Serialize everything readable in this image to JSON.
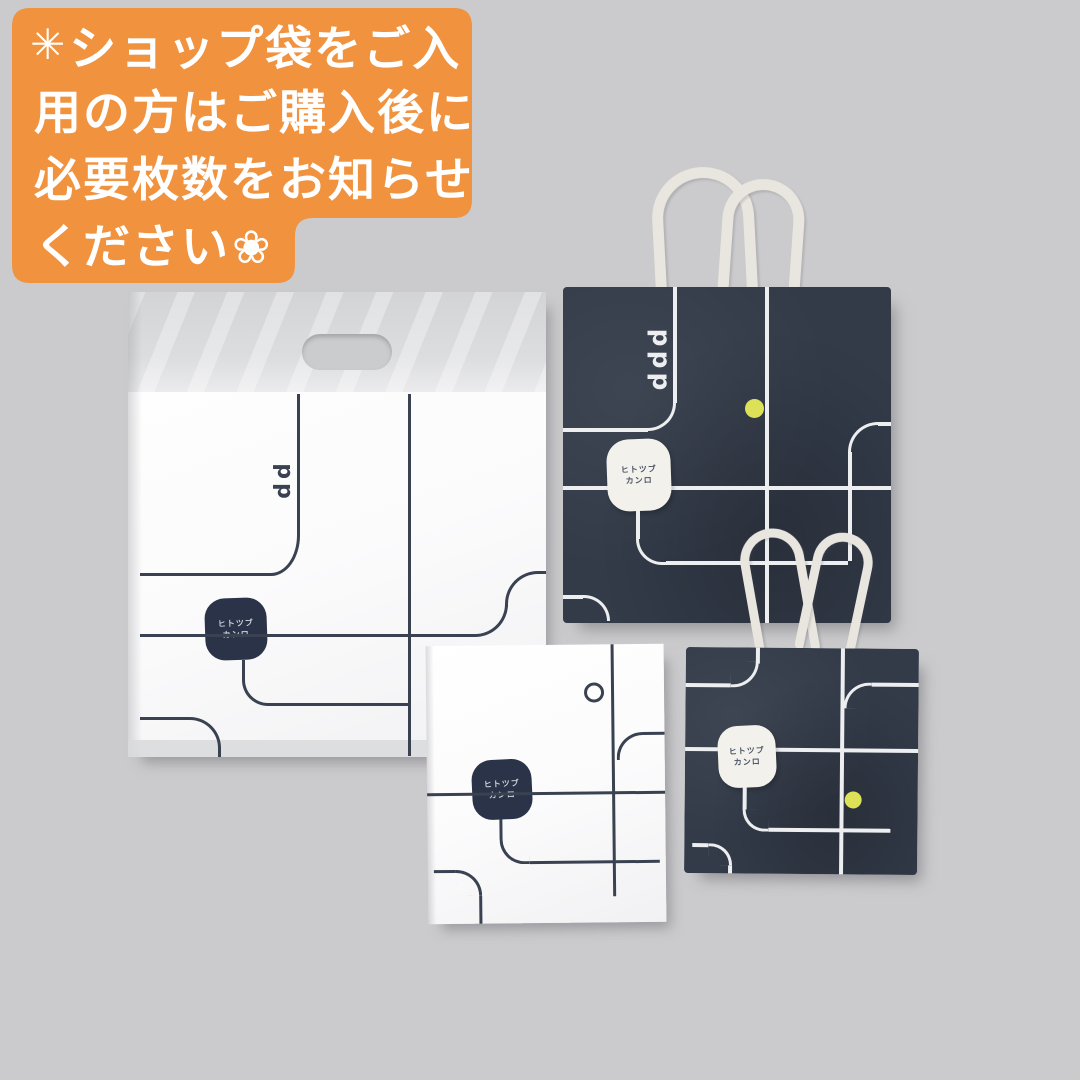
{
  "scene": {
    "description": "Four branded shop bags (large white plastic bag, large navy paper bag, small white paper bag, small navy paper bag) photographed on a gray background with an orange Japanese notice overlay."
  },
  "banner": {
    "bg_color": "#f0923e",
    "text_color": "#ffffff",
    "sparkle_icon": "✳",
    "flower_icon": "❀",
    "line1": "ショップ袋をご入",
    "line2": "用の方はご購入後に",
    "line3": "必要枚数をお知らせ",
    "line4": "ください"
  },
  "bags": {
    "plastic_bag": {
      "base_color": "#fbfbfc",
      "top_band_color": "#d8d9db",
      "pattern_color": "#3a4252",
      "motif": "dd",
      "label_line1": "ヒトツブ",
      "label_line2": "カンロ",
      "label_bg": "#2a3347",
      "label_text_color": "#ccd2dd"
    },
    "large_navy_bag": {
      "base_color": "#333b49",
      "pattern_color": "#eceef0",
      "motif": "ddd",
      "dot_color": "#dde158",
      "cord_color": "#e9e6df",
      "label_line1": "ヒトツブ",
      "label_line2": "カンロ",
      "label_bg": "#f2f1ec",
      "label_text_color": "#4a5365"
    },
    "small_white_bag": {
      "base_color": "#fbfbfc",
      "pattern_color": "#3a4252",
      "label_line1": "ヒトツブ",
      "label_line2": "カンロ",
      "label_bg": "#2a3347",
      "label_text_color": "#ccd2dd"
    },
    "small_navy_bag": {
      "base_color": "#333b49",
      "pattern_color": "#eceef0",
      "dot_color": "#dde158",
      "cord_color": "#e9e6df",
      "label_line1": "ヒトツブ",
      "label_line2": "カンロ",
      "label_bg": "#f2f1ec",
      "label_text_color": "#4a5365"
    }
  },
  "colors": {
    "background": "#cbcbcd",
    "banner_orange": "#f0923e",
    "navy": "#333b49",
    "yellow_dot": "#dde158",
    "cord": "#e9e6df"
  }
}
